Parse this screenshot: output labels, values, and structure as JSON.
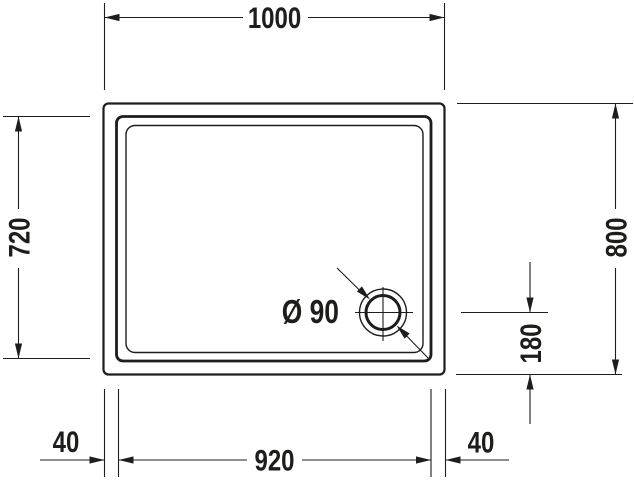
{
  "drawing": {
    "background": "#ffffff",
    "line_color": "#1d1d1b",
    "dimensions": {
      "top_width": "1000",
      "left_depth": "720",
      "right_height": "800",
      "drain_offset": "180",
      "bottom_margin_left": "40",
      "bottom_inner_width": "920",
      "bottom_margin_right": "40",
      "drain_diameter": "Ø 90"
    }
  }
}
